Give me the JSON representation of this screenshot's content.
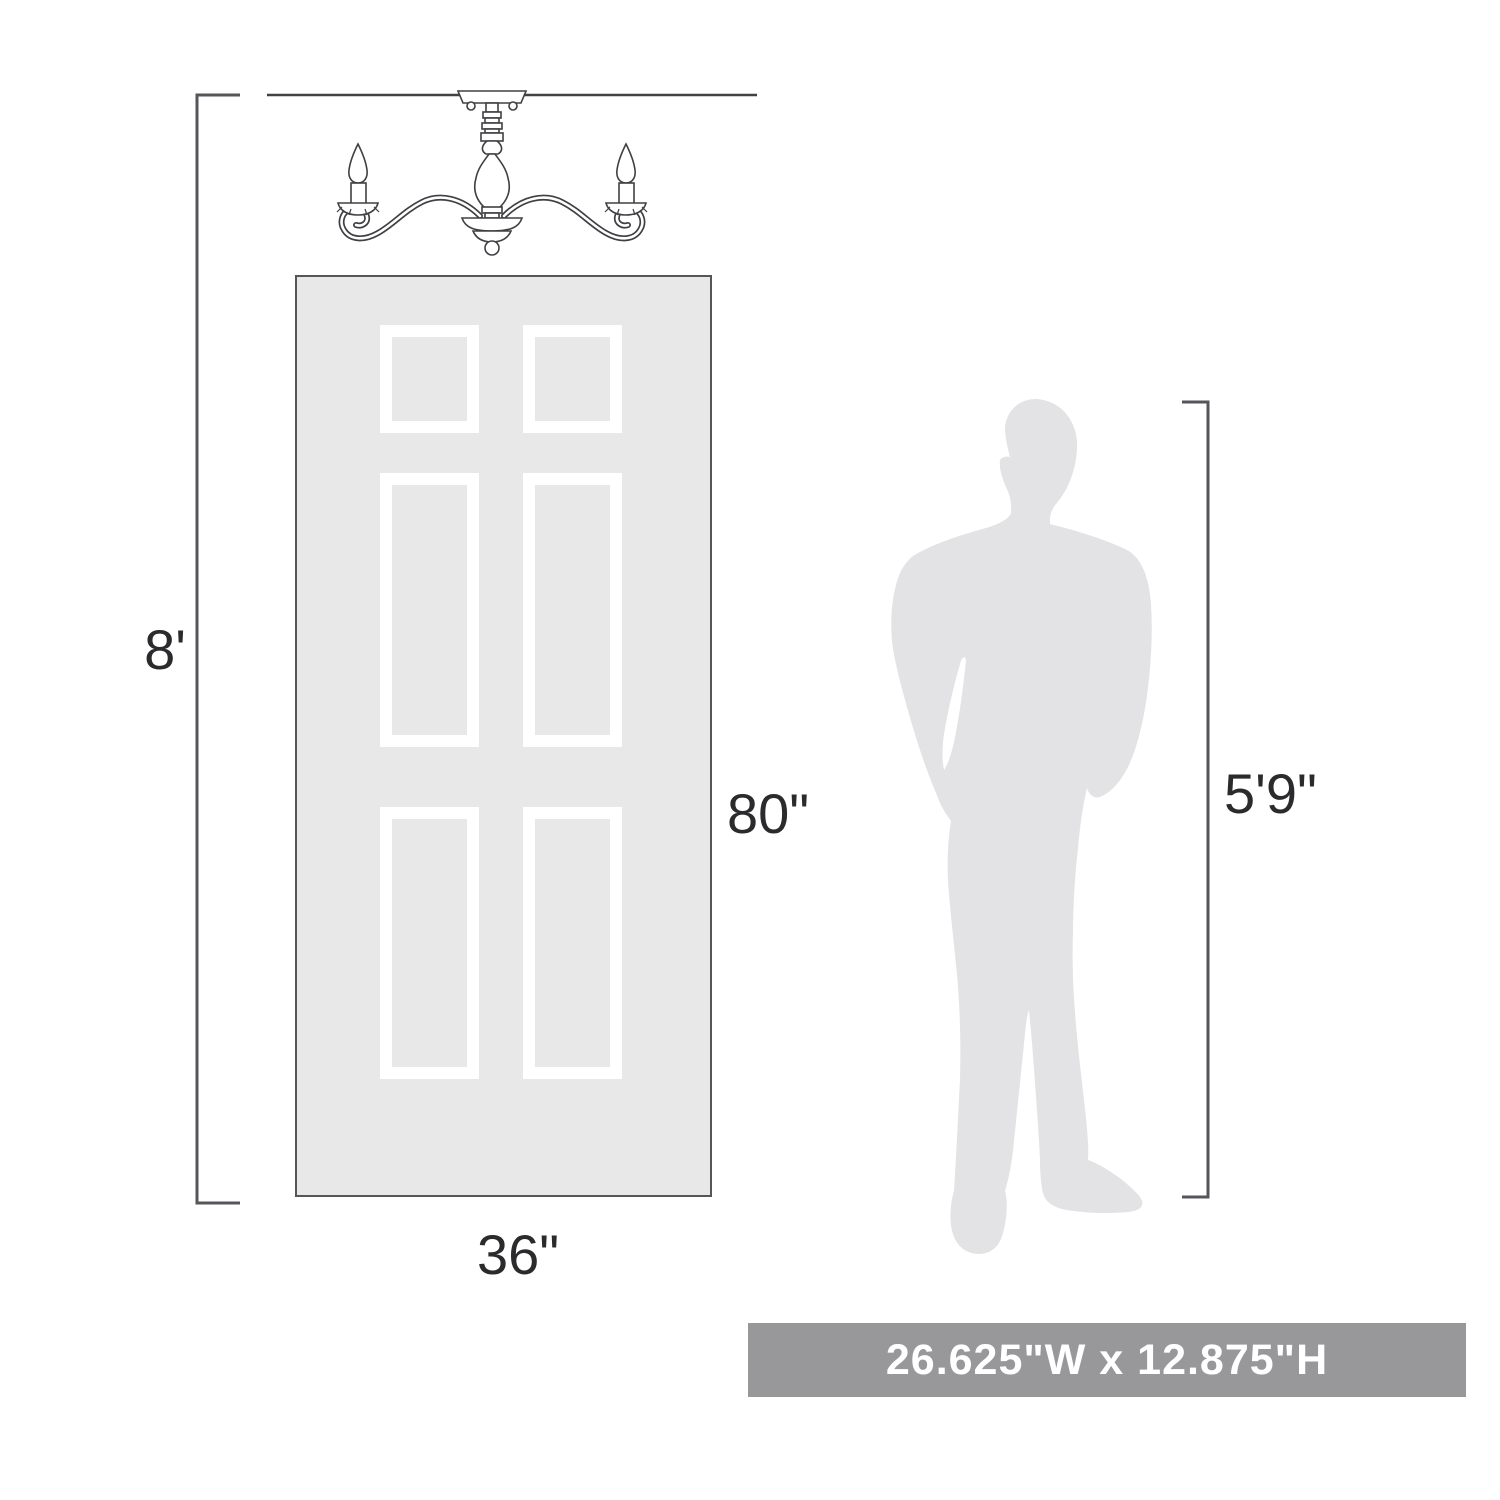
{
  "colors": {
    "background": "#ffffff",
    "door_fill": "#e8e8e9",
    "door_border": "#55565a",
    "panel_frame": "#ffffff",
    "silhouette": "#e3e3e5",
    "line": "#404044",
    "dim_line": "#55565a",
    "label_text": "#2b2b2e",
    "banner_bg": "#98989b",
    "banner_text": "#ffffff"
  },
  "labels": {
    "ceiling_height": "8'",
    "door_height": "80\"",
    "door_width": "36\"",
    "person_height": "5'9\"",
    "product_size": "26.625\"W x 12.875\"H"
  },
  "icons": {
    "chandelier_drawing": "two-arm-candle-chandelier-line-art",
    "man_silhouette": "standing-man-silhouette",
    "door_drawing": "six-panel-door"
  }
}
